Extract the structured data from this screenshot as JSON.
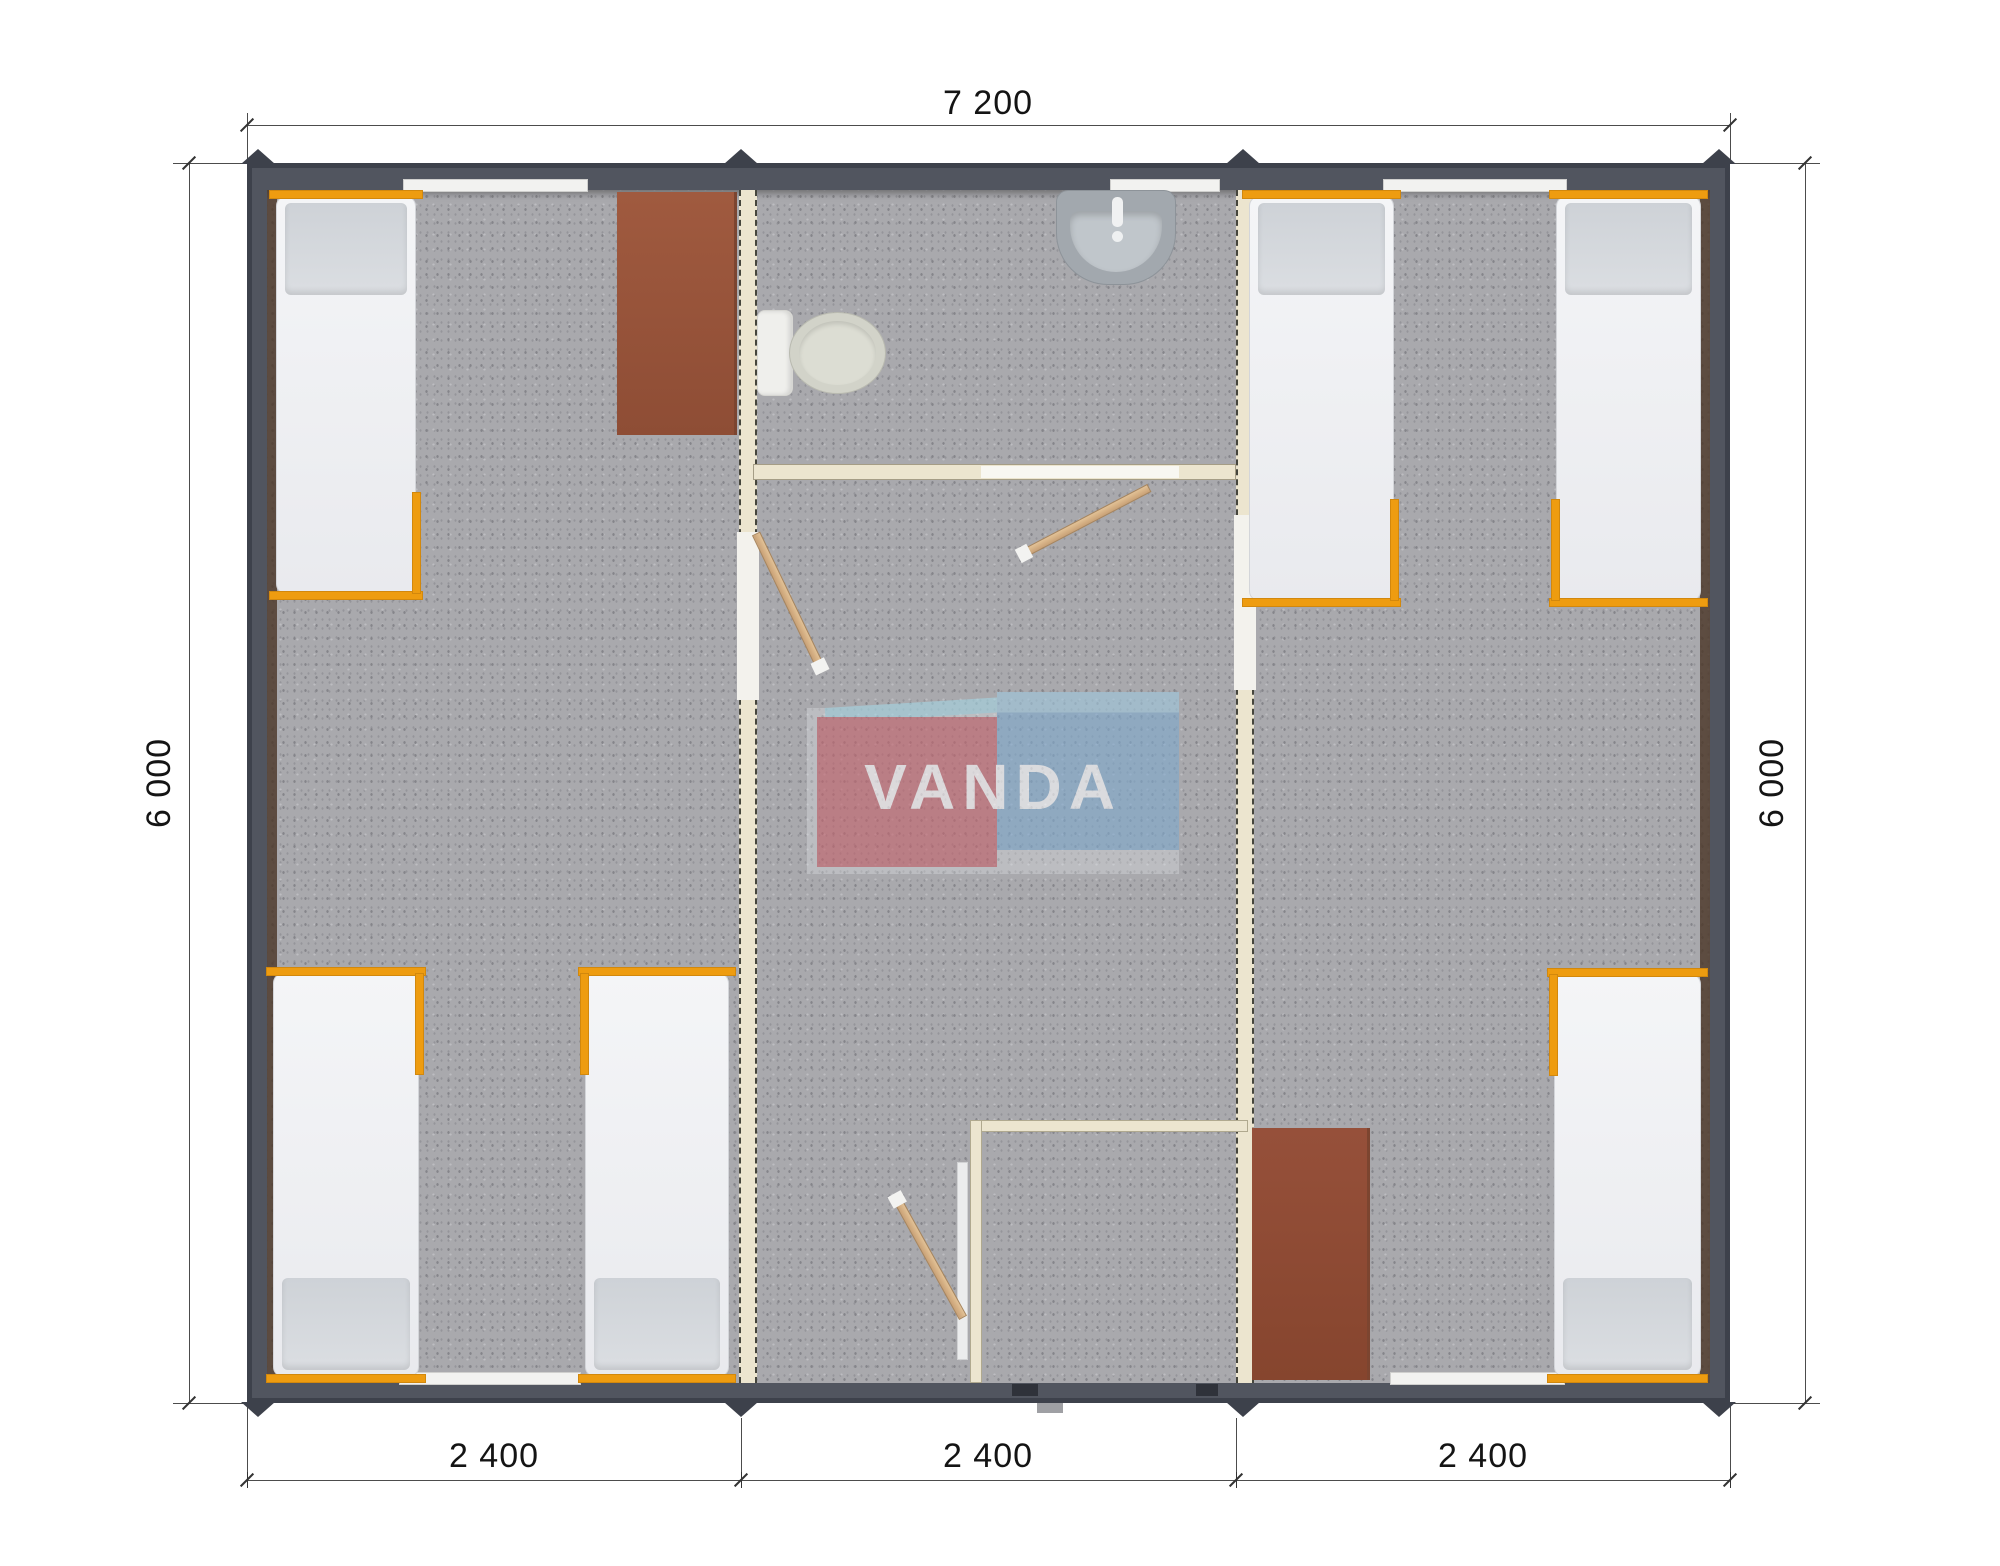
{
  "title": "Modular house floor plan (top view render)",
  "dimensions": {
    "top": "7 200",
    "left": "6 000",
    "right": "6 000",
    "bottom": [
      "2 400",
      "2 400",
      "2 400"
    ]
  },
  "watermark": {
    "text": "VANDA",
    "red_box_color": "#c5646e",
    "blue_box_color": "#80a9cd",
    "light_blue_color": "#a5d4e2",
    "text_color": "#ffffff"
  },
  "colors": {
    "outer_wall": "#3d414b",
    "wall_band": "#51555f",
    "floor": "#a9a9ad",
    "partition": "#ece5cf",
    "bed_frame_accent": "#ee9c10",
    "mattress": "#f1f2f4",
    "pillow": "#d3d6da",
    "wardrobe": "#9a563c",
    "door_wood": "#d8b488",
    "toilet": "#d2d3c9",
    "sink": "#a2a8ae",
    "dimension_line": "#4c4c4c"
  },
  "furniture": {
    "beds": [
      "bed-top-left",
      "bed-bottom-left-1",
      "bed-bottom-left-2",
      "bed-top-right-1",
      "bed-top-right-2",
      "bed-bottom-right"
    ],
    "wardrobes": [
      "wardrobe-top-left",
      "wardrobe-bottom-right"
    ],
    "sanitary": [
      "toilet",
      "sink"
    ],
    "doors": [
      "bathroom-door",
      "left-room-door",
      "lobby-door"
    ]
  }
}
